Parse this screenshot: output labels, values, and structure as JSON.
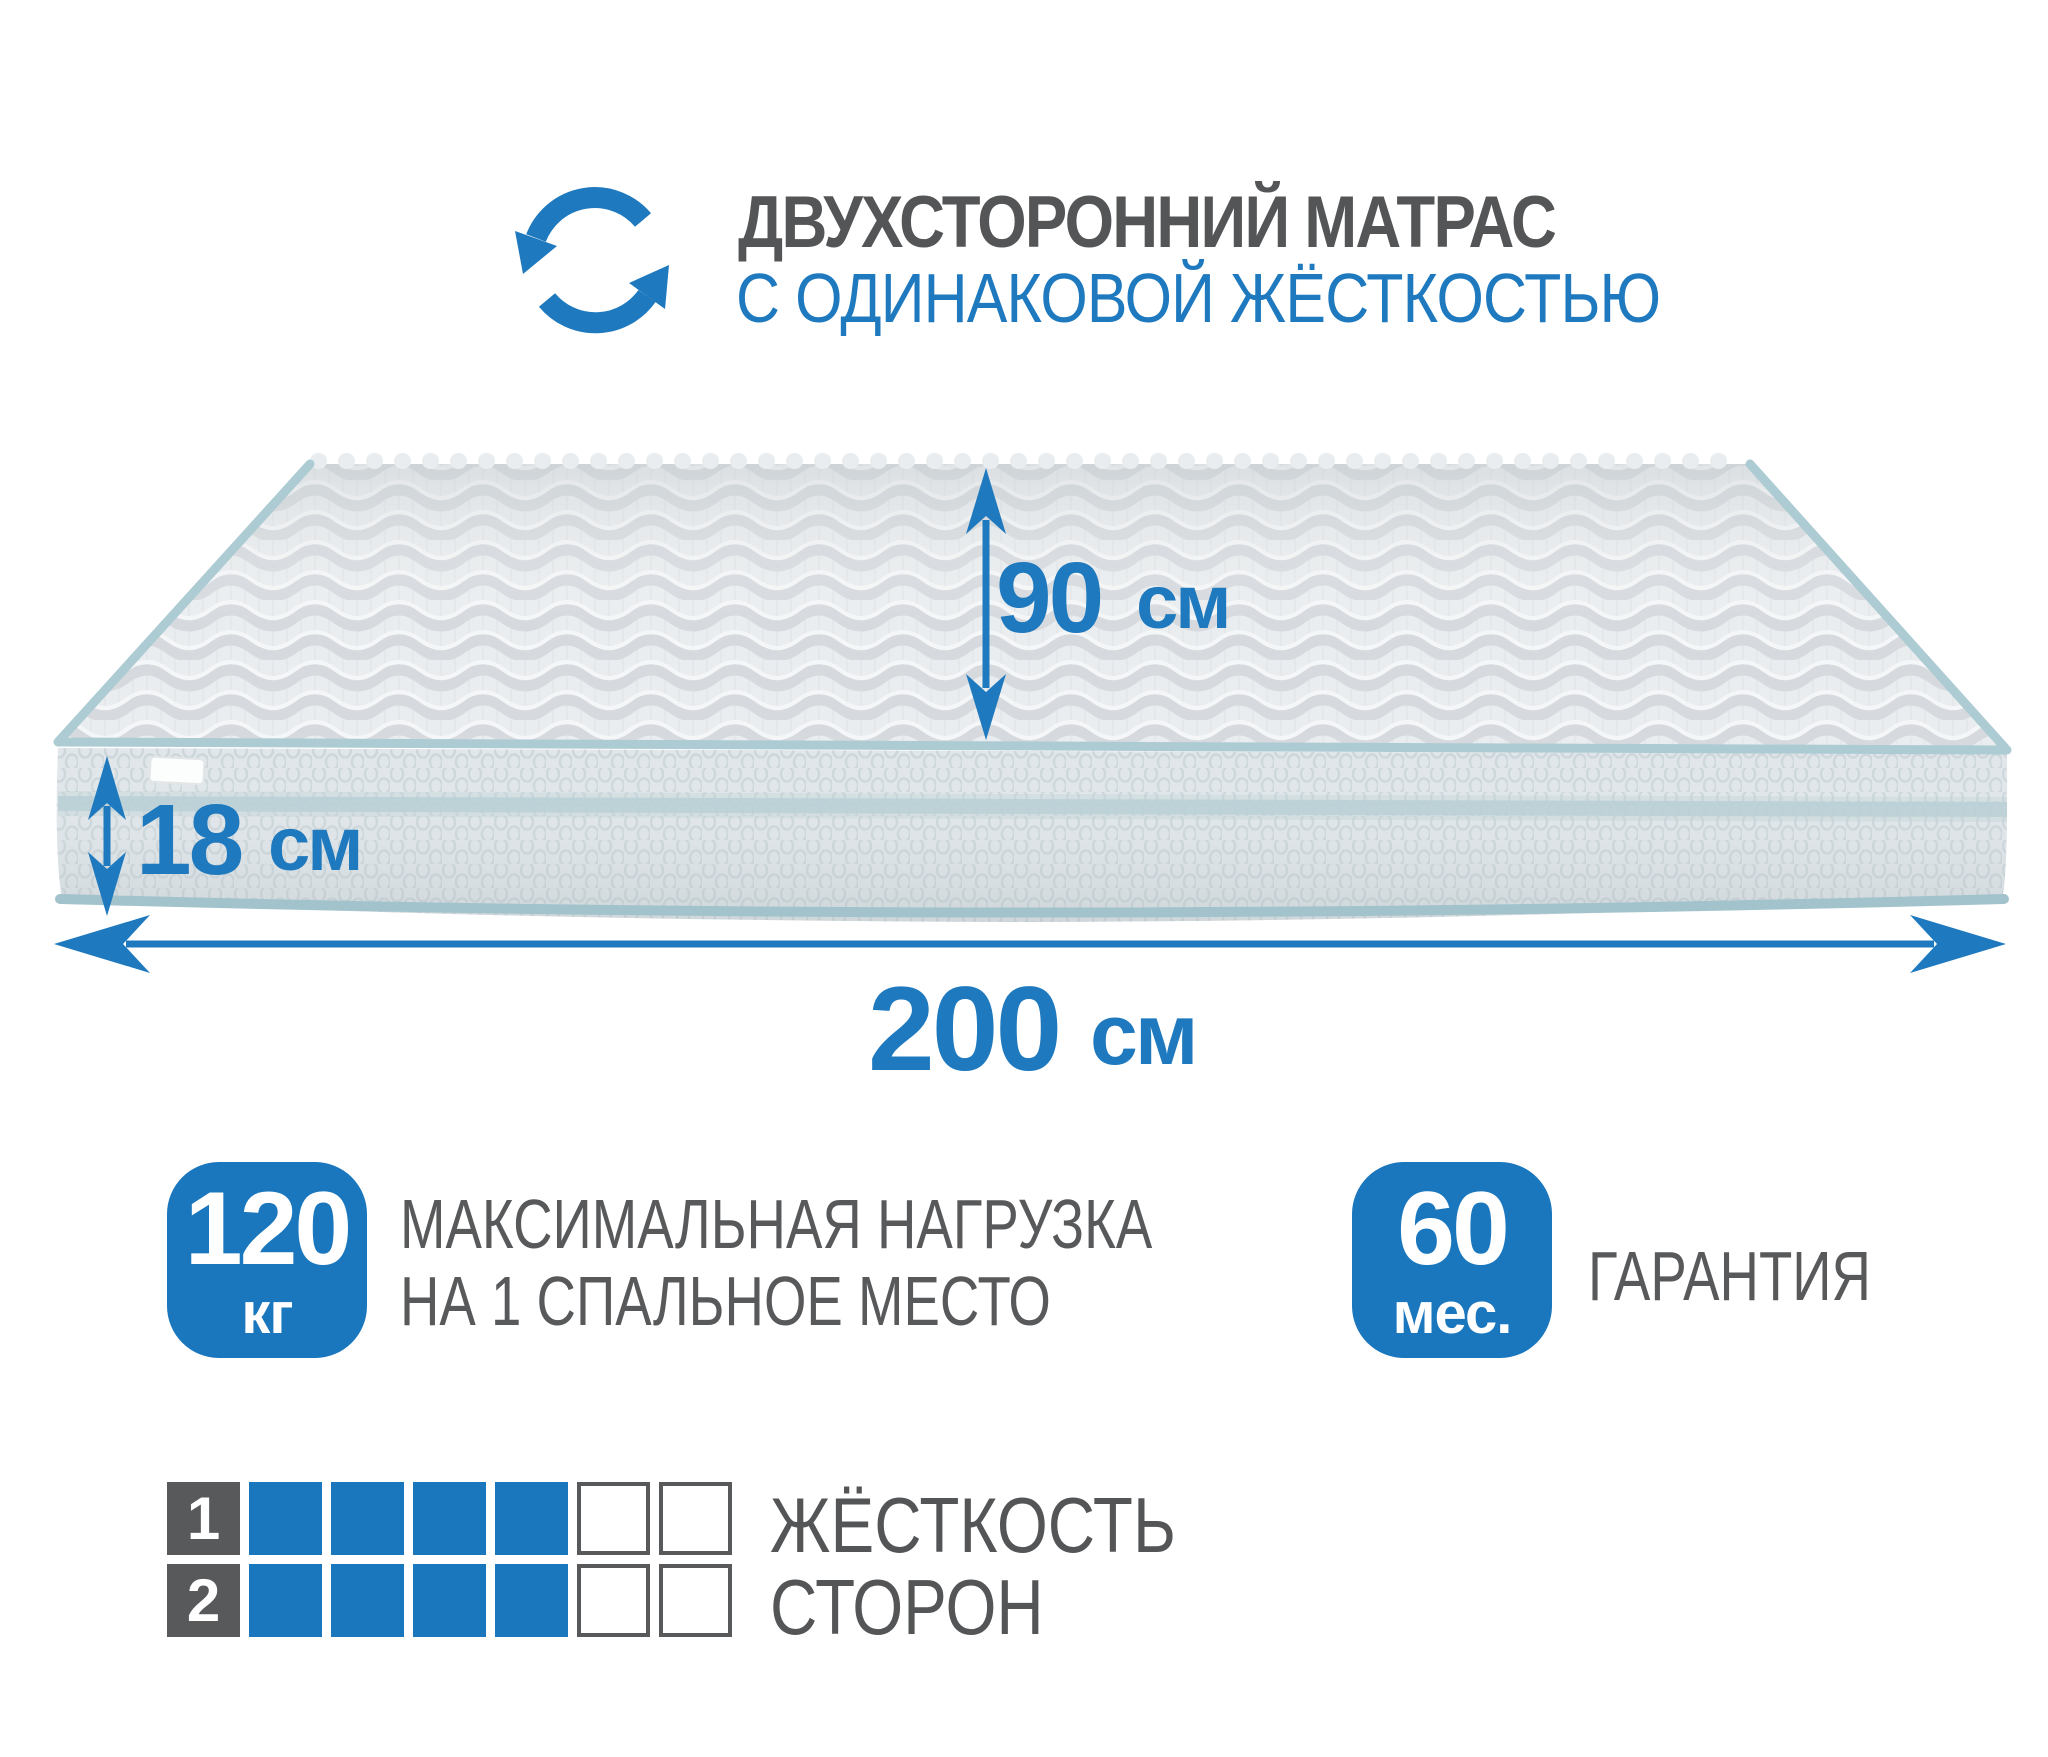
{
  "header": {
    "icon": "rotate-arrows",
    "title": "ДВУХСТОРОННИЙ МАТРАС",
    "subtitle": "С ОДИНАКОВОЙ ЖЁСТКОСТЬЮ"
  },
  "dimensions": {
    "depth": {
      "value": "90",
      "unit": "см"
    },
    "height": {
      "value": "18",
      "unit": "см"
    },
    "width": {
      "value": "200",
      "unit": "см"
    }
  },
  "features": {
    "max_load": {
      "value": "120",
      "unit": "кг",
      "label_line1": "МАКСИМАЛЬНАЯ НАГРУЗКА",
      "label_line2": "НА 1 СПАЛЬНОЕ МЕСТО"
    },
    "warranty": {
      "value": "60",
      "unit": "мес.",
      "label": "ГАРАНТИЯ"
    }
  },
  "firmness": {
    "label_line1": "ЖЁСТКОСТЬ",
    "label_line2": "СТОРОН",
    "scale_max": 6,
    "sides": [
      {
        "number": "1",
        "level": 4
      },
      {
        "number": "2",
        "level": 4
      }
    ]
  },
  "colors": {
    "accent": "#1e79be",
    "badge_blue": "#1b77bd",
    "dark_gray": "#58595b",
    "title_gray": "#545557",
    "piping": "#adcbd3",
    "side_band": "#b7ced5"
  }
}
